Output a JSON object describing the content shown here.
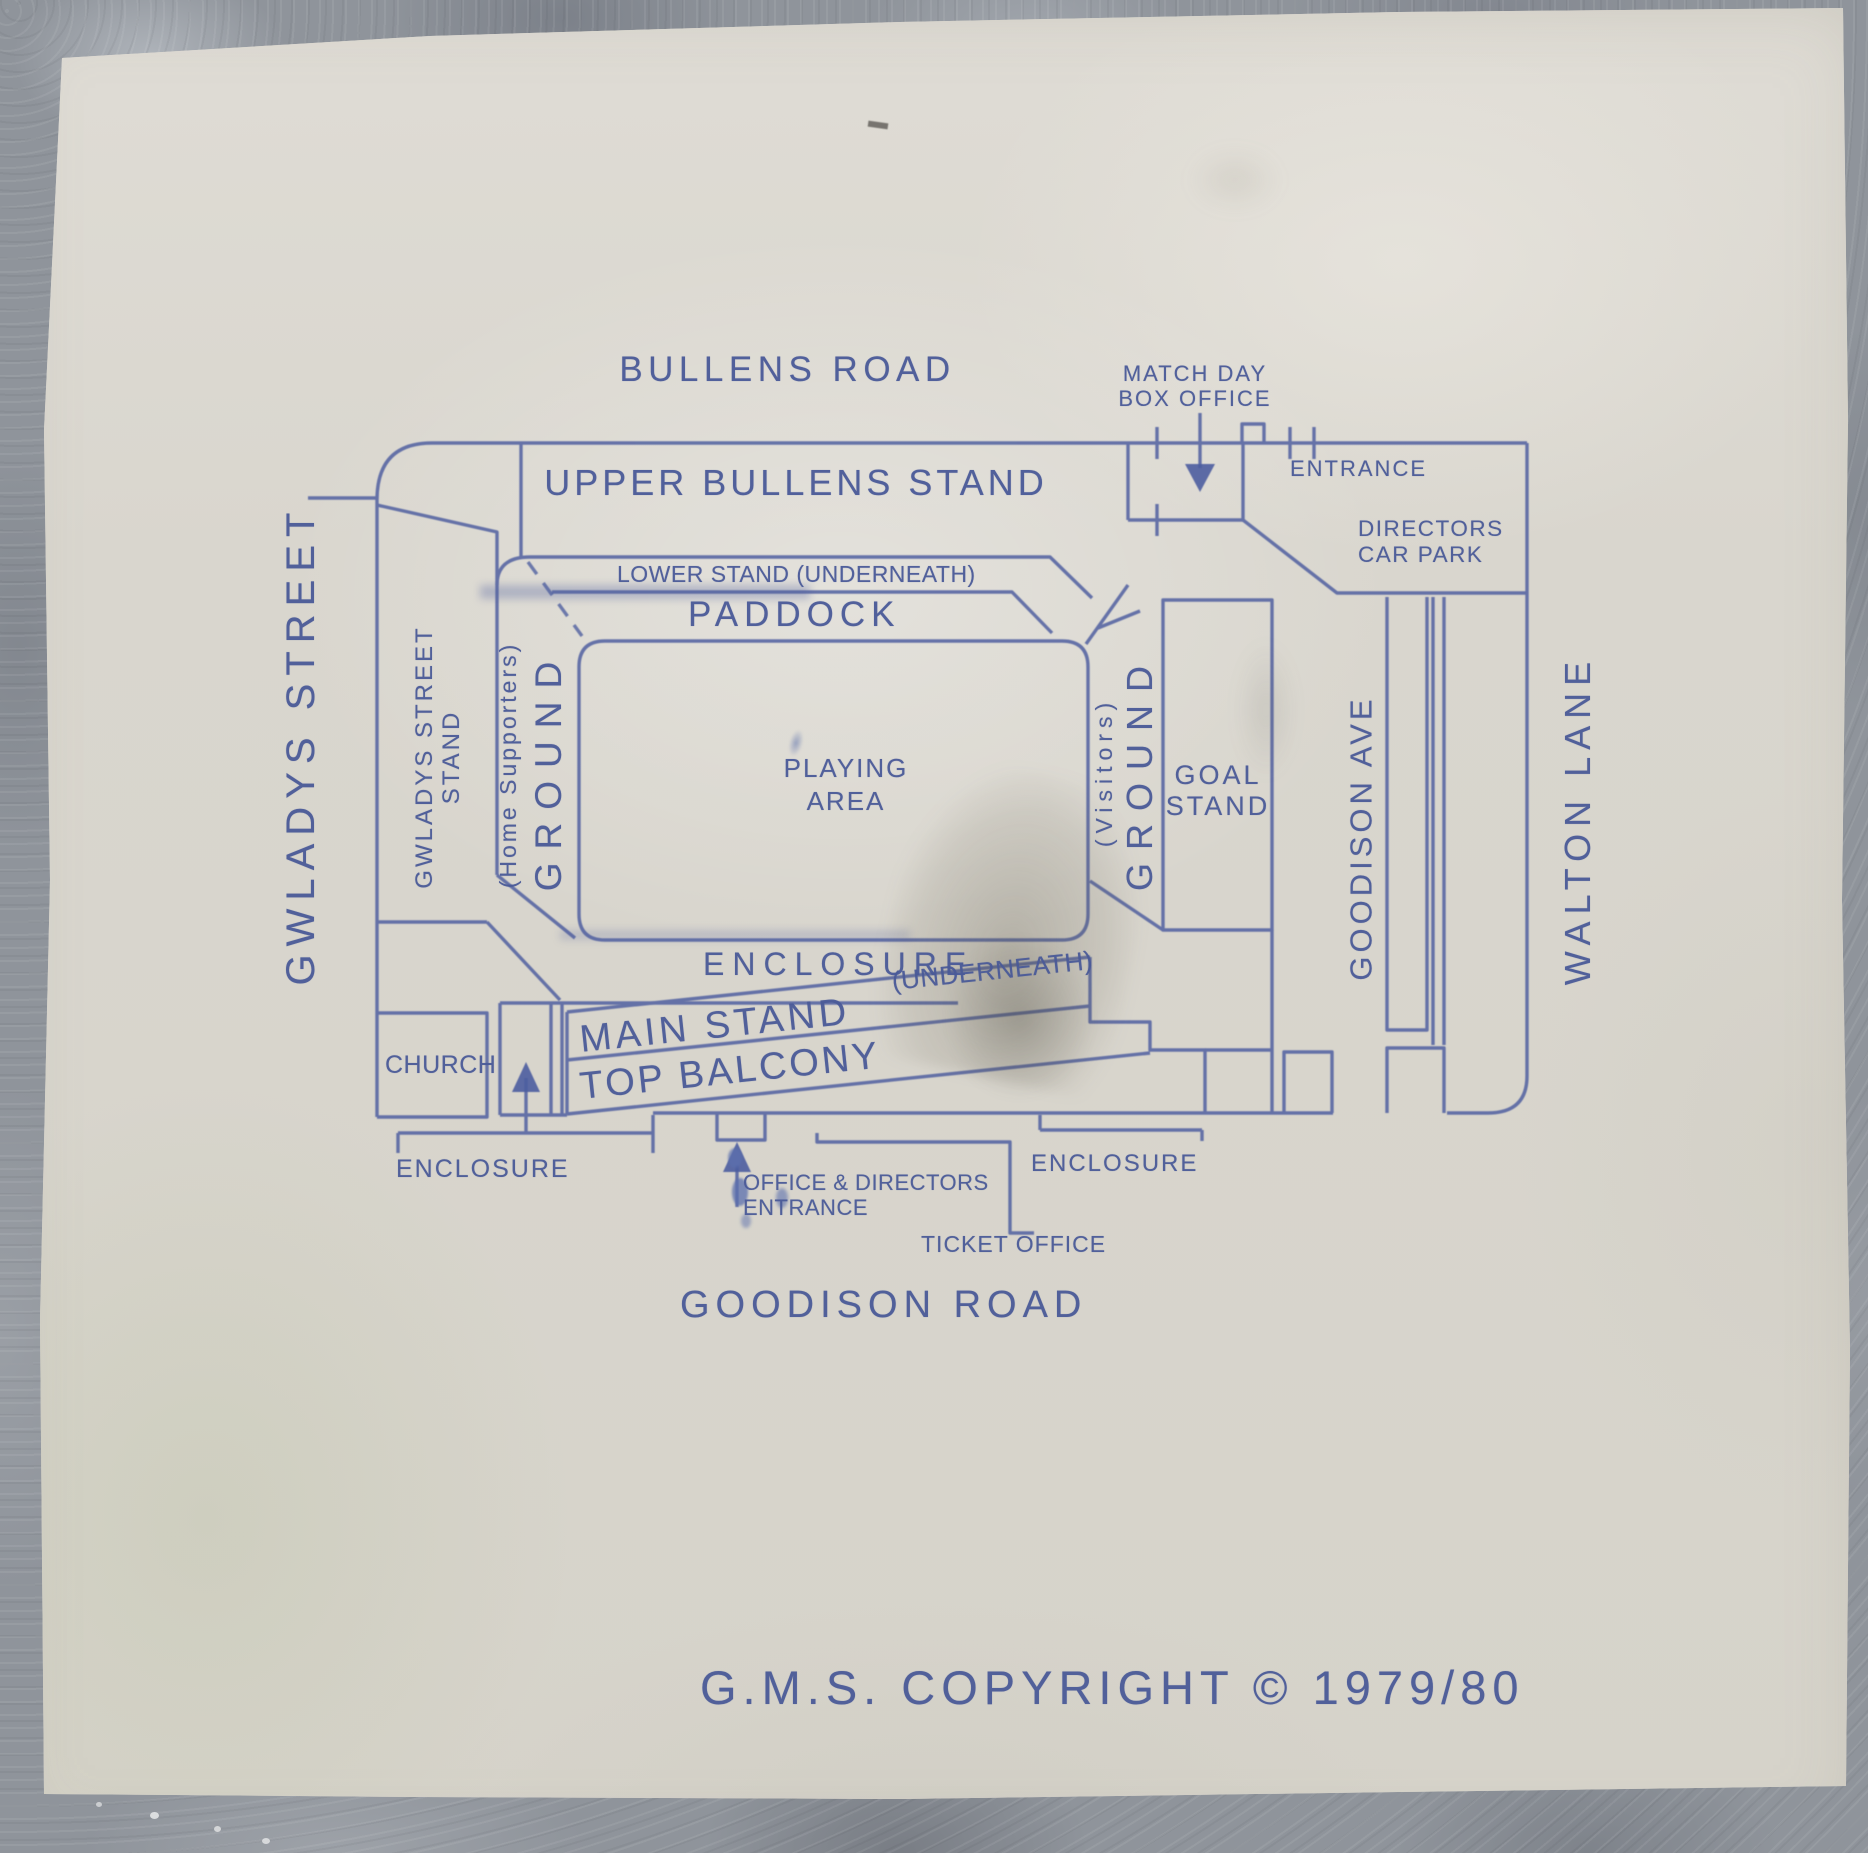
{
  "streets": {
    "top": "BULLENS ROAD",
    "left": "GWLADYS STREET",
    "bottom": "GOODISON ROAD",
    "right_inner": "GOODISON AVE",
    "right_outer": "WALTON LANE"
  },
  "north_side": {
    "upper_stand": "UPPER BULLENS STAND",
    "lower_stand": "LOWER STAND (UNDERNEATH)",
    "paddock": "PADDOCK",
    "box_office_line1": "MATCH DAY",
    "box_office_line2": "BOX OFFICE",
    "entrance": "ENTRANCE"
  },
  "east_side": {
    "directors_line1": "DIRECTORS",
    "directors_line2": "CAR PARK",
    "goal_line1": "GOAL",
    "goal_line2": "STAND",
    "visitors": "(Visitors)",
    "ground": "GROUND"
  },
  "west_side": {
    "stand_line1": "GWLADYS STREET",
    "stand_line2": "STAND",
    "home_supporters": "(Home Supporters)",
    "ground": "GROUND",
    "church": "CHURCH"
  },
  "pitch": {
    "line1": "PLAYING",
    "line2": "AREA",
    "enclosure": "ENCLOSURE"
  },
  "main_stand": {
    "name": "MAIN STAND",
    "underneath": "(UNDERNEATH)",
    "balcony": "TOP BALCONY",
    "enclosure_west": "ENCLOSURE",
    "enclosure_east": "ENCLOSURE",
    "office_line1": "OFFICE & DIRECTORS",
    "office_line2": "ENTRANCE",
    "ticket_office": "TICKET OFFICE"
  },
  "copyright": "G.M.S. COPYRIGHT © 1979/80",
  "colors": {
    "ink_text": "#4a5a98",
    "ink_line": "#5060a0",
    "paper": "#d9d6ce",
    "stone": "#8f949b"
  }
}
